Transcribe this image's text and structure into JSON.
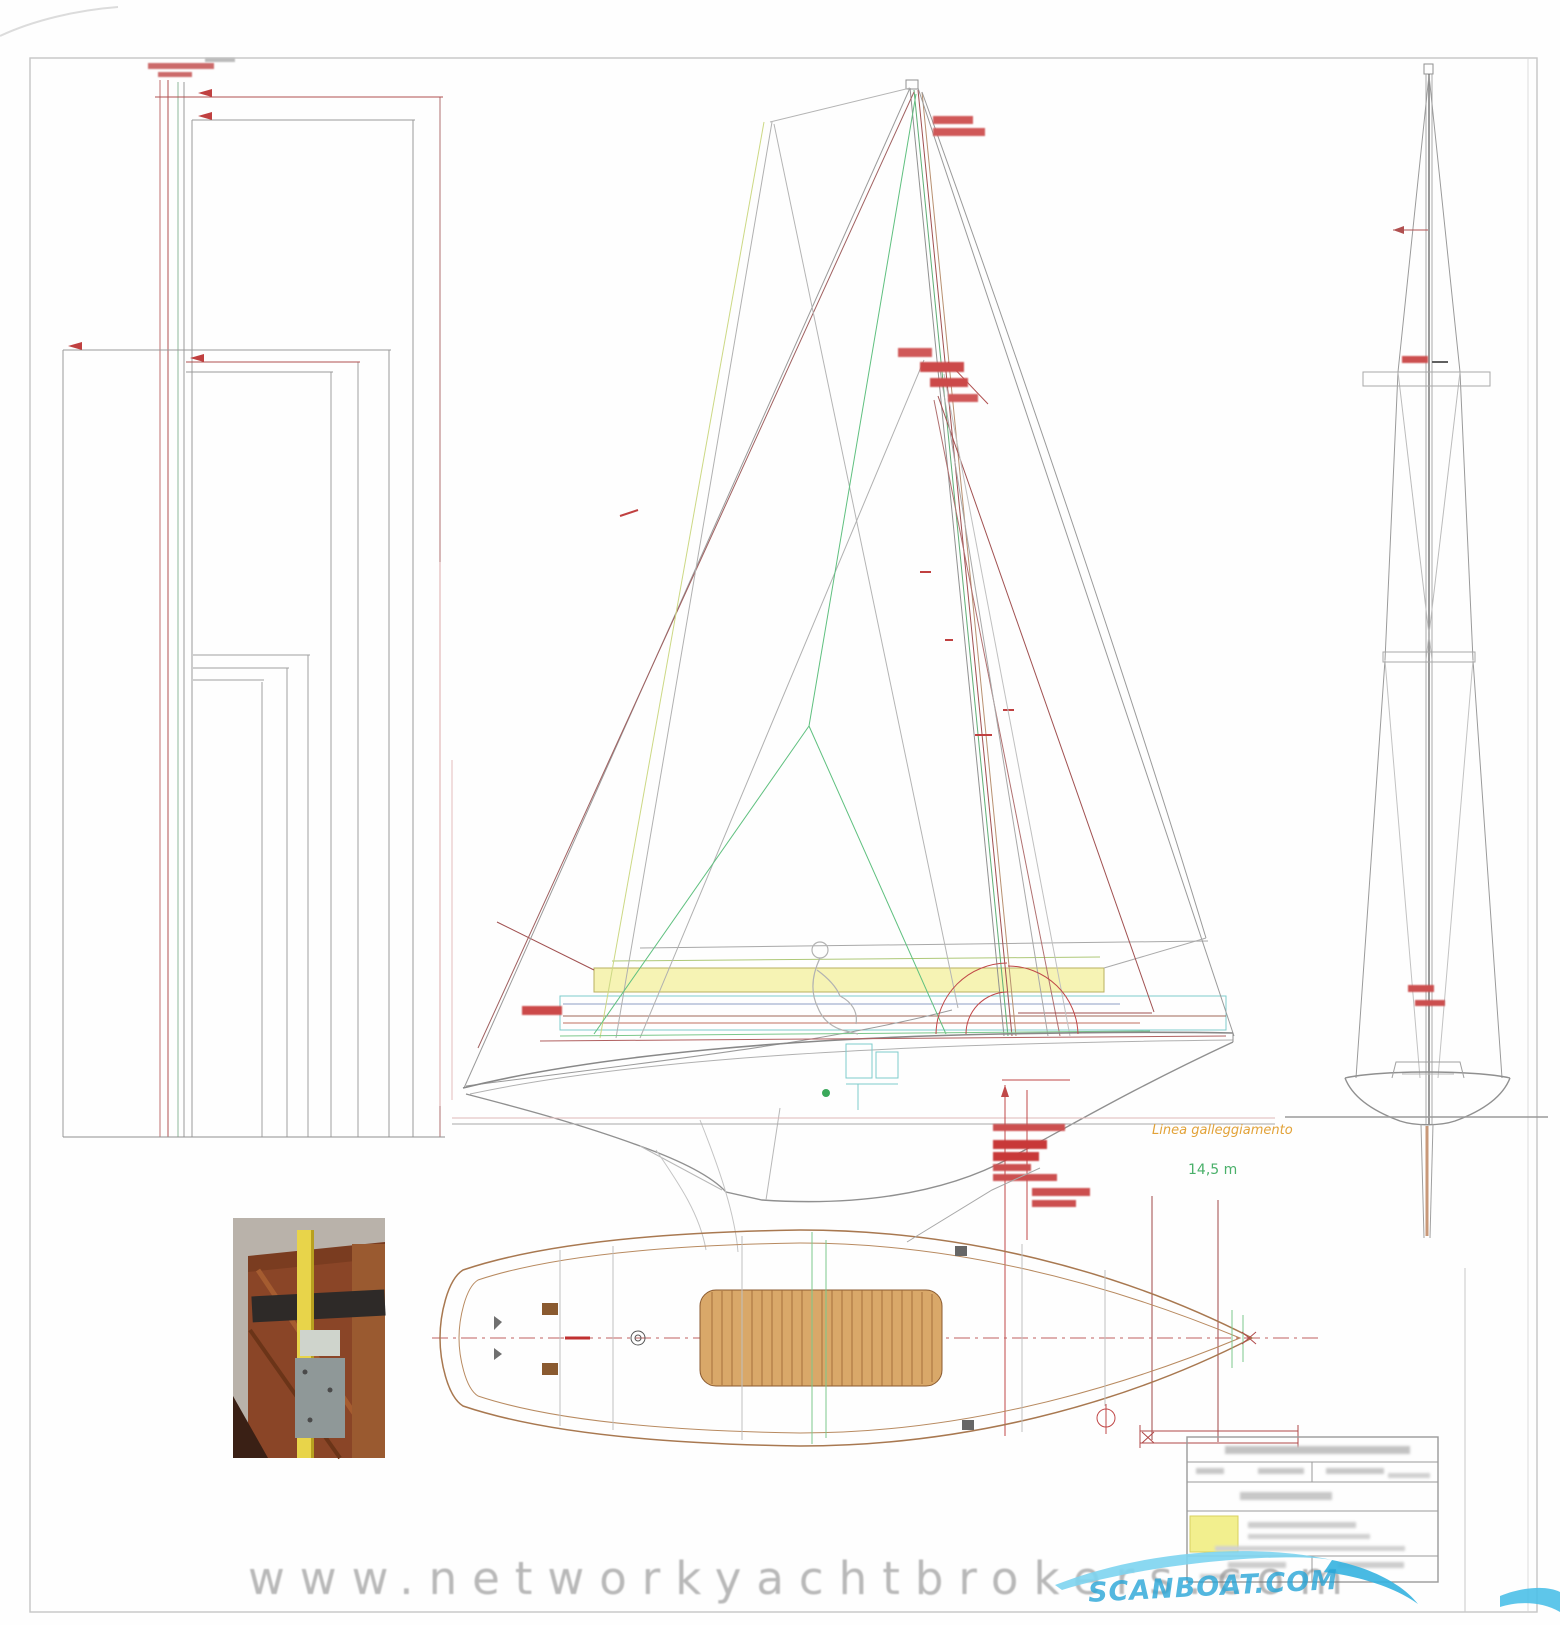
{
  "page": {
    "width": 1560,
    "height": 1625,
    "background": "#fefefe",
    "sheet_border_color": "#c6c6c6"
  },
  "watermark": {
    "text": "www.networkyachtbrokers.com",
    "color": "#8c8c8c"
  },
  "logo": {
    "text": "SCANBOAT.COM",
    "color": "#2aa9db"
  },
  "drawing_labels": {
    "waterline_label": "Linea galleggiamento",
    "waterline_label_color": "#e8a030",
    "keel_measurement": "14,5 m",
    "keel_measurement_color": "#48b068"
  },
  "palette": {
    "dimension_red": "#c04848",
    "structure_gray": "#9a9a9a",
    "rigging_green": "#5fc07f",
    "hull_tan": "#a87850",
    "boom_highlight_yellow": "#f6f3b4",
    "detail_cyan": "#7ecccc",
    "title_block_highlight": "#f2ef8e"
  }
}
